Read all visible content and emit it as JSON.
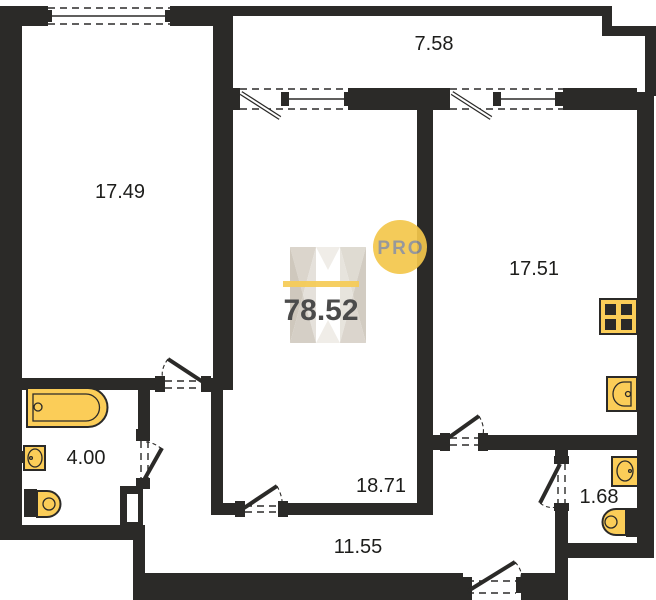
{
  "plan": {
    "watermark": {
      "total_area": "78.52",
      "badge": "PRO"
    },
    "rooms": [
      {
        "name": "living-room-left",
        "area": "17.49"
      },
      {
        "name": "balcony",
        "area": "7.58"
      },
      {
        "name": "kitchen-room-right",
        "area": "17.51"
      },
      {
        "name": "center-room",
        "area": "18.71"
      },
      {
        "name": "bathroom",
        "area": "4.00"
      },
      {
        "name": "hallway",
        "area": "11.55"
      },
      {
        "name": "wc",
        "area": "1.68"
      }
    ],
    "fixtures": [
      {
        "icon": "bathtub-icon"
      },
      {
        "icon": "bathroom-sink-icon"
      },
      {
        "icon": "bathroom-toilet-icon"
      },
      {
        "icon": "stove-icon"
      },
      {
        "icon": "kitchen-sink-icon"
      },
      {
        "icon": "wc-sink-icon"
      },
      {
        "icon": "wc-toilet-icon"
      }
    ],
    "colors": {
      "wall": "#2b2a28",
      "fixture_fill": "#fbcd58",
      "accent_yellow": "#f4c74b",
      "badge_text": "#8f9094",
      "area_text": "#3c3c3c",
      "label_text": "#1d1d1b"
    }
  }
}
